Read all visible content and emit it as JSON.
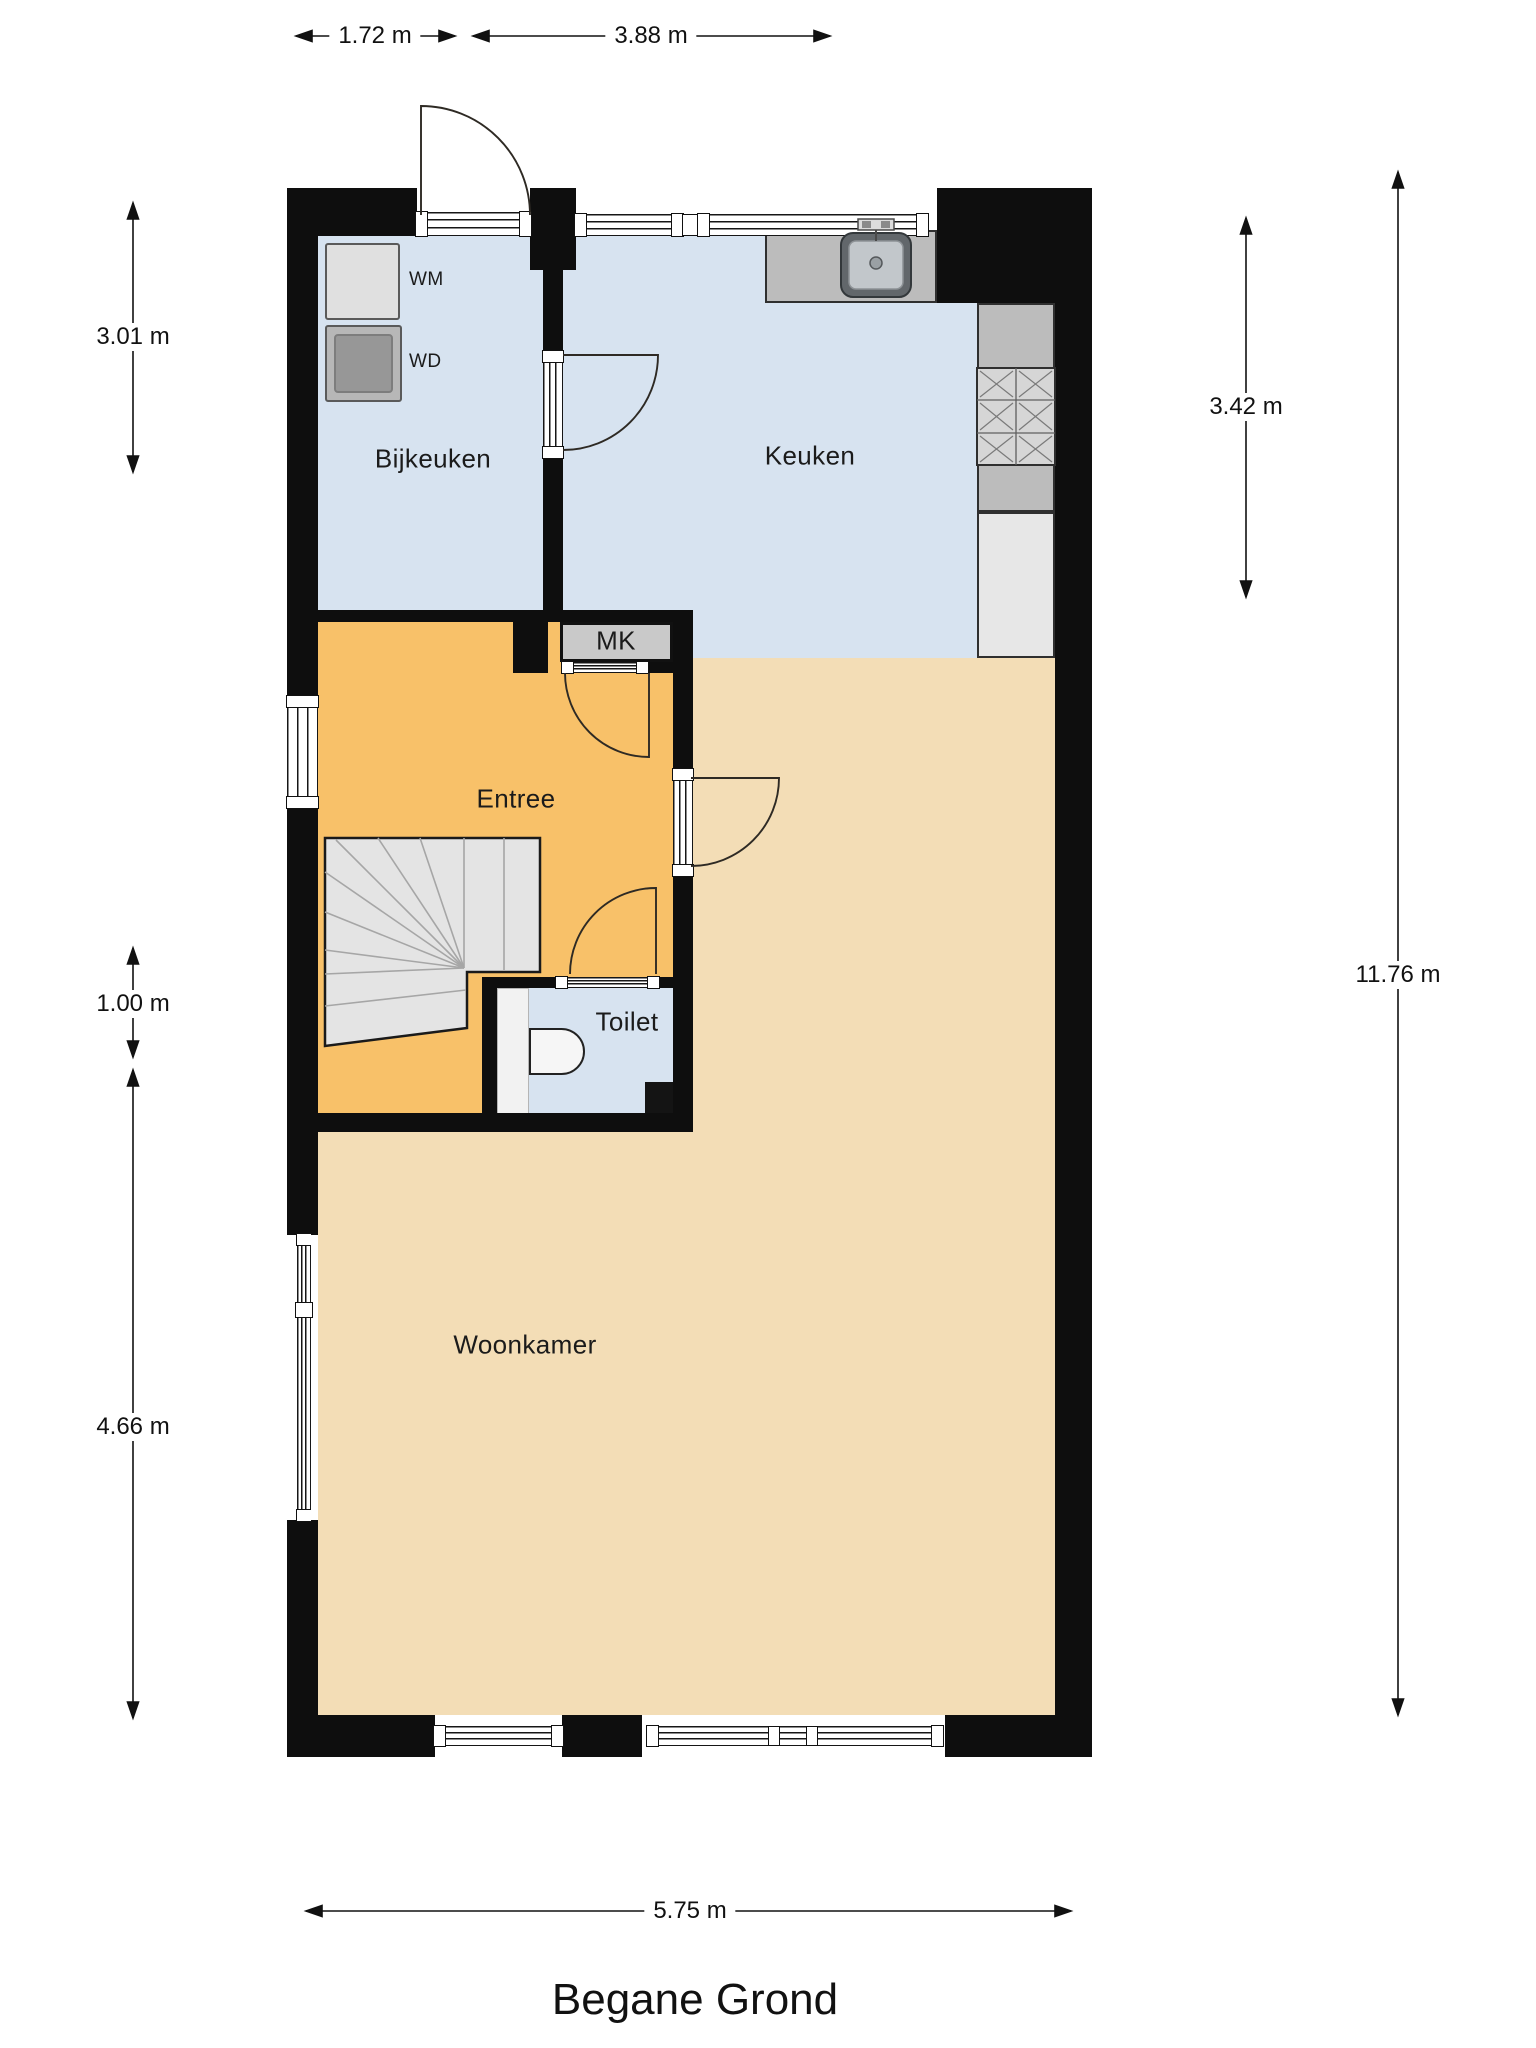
{
  "title": "Begane Grond",
  "rooms": {
    "bijkeuken": {
      "label": "Bijkeuken"
    },
    "keuken": {
      "label": "Keuken"
    },
    "entree": {
      "label": "Entree"
    },
    "toilet": {
      "label": "Toilet"
    },
    "woonkamer": {
      "label": "Woonkamer"
    },
    "mk": {
      "label": "MK"
    }
  },
  "appliances": {
    "wm": {
      "label": "WM"
    },
    "wd": {
      "label": "WD"
    }
  },
  "fixtures": [
    "kitchen-sink-icon",
    "stove-hob-icon",
    "toilet-bowl-icon",
    "winder-staircase"
  ],
  "dimensions": {
    "top_left": "1.72 m",
    "top_right": "3.88 m",
    "left_upper": "3.01 m",
    "left_middle": "1.00 m",
    "left_lower": "4.66 m",
    "right_upper": "3.42 m",
    "right_outer": "11.76 m",
    "bottom": "5.75 m"
  },
  "colors": {
    "wall": "#0e0e0e",
    "wet_room_floor": "#d7e3f0",
    "entree_floor": "#f8c169",
    "woonkamer_floor": "#f3ddb6",
    "counter": "#bcbcbc",
    "stairs": "#e4e4e4"
  }
}
